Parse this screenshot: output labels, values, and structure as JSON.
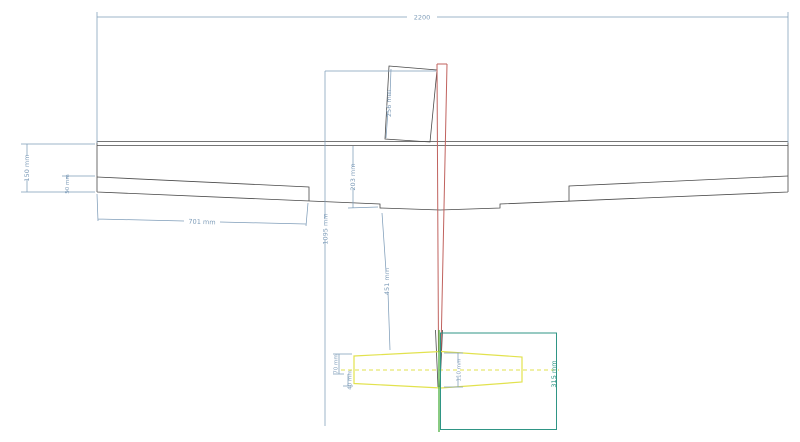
{
  "colors": {
    "dimension": "#7f9db9",
    "outline": "#4a4a4a",
    "fuselage": "#c0625e",
    "stabilizer": "#e2e24e",
    "tail_box": "#2f9585",
    "fin": "#58b54c"
  },
  "dimensions": {
    "wingspan": "2200",
    "tip_chord": "150 mm",
    "aileron_tip_chord": "50 mm",
    "aileron_span": "701 mm",
    "fuselage_length": "1095 mm",
    "nose_section": "256 mm",
    "root_chord": "203 mm",
    "wing_to_tail": "451 mm",
    "stab_front": "70 mm",
    "elevator_chord": "40 mm",
    "stab_root_chord": "110 mm",
    "tail_box_height": "315 mm"
  }
}
